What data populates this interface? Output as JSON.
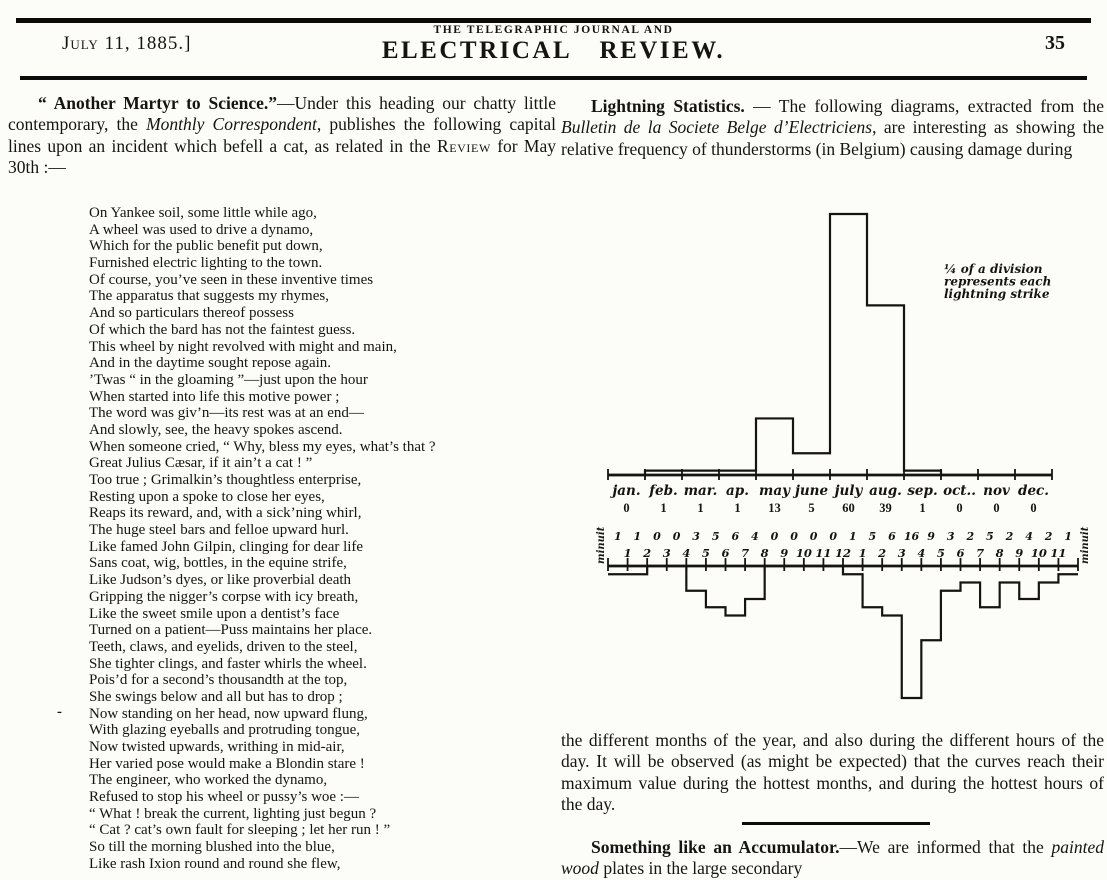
{
  "header": {
    "date": "July 11, 1885.]",
    "journal_line1": "THE TELEGRAPHIC JOURNAL AND",
    "journal_line2": "ELECTRICAL REVIEW.",
    "page_number": "35"
  },
  "left_column": {
    "intro": [
      [
        "bold",
        "“ Another Martyr to Science.”"
      ],
      [
        "plain",
        "—Under this heading our chatty little contemporary, the "
      ],
      [
        "italic",
        "Monthly Correspondent"
      ],
      [
        "plain",
        ", publishes the following capital lines upon an incident which befell a cat, as related in the "
      ],
      [
        "smallcaps",
        "Review"
      ],
      [
        "plain",
        " for May 30th :—"
      ]
    ],
    "margin_dash": "-",
    "poem_lines": [
      "On Yankee soil, some little while ago,",
      "A wheel was used to drive a dynamo,",
      "Which for the public benefit put down,",
      "Furnished electric lighting to the town.",
      "Of course, you’ve seen in these inventive times",
      "The apparatus that suggests my rhymes,",
      "And so particulars thereof  possess",
      "Of which the bard has not the faintest guess.",
      "This wheel by night revolved with might and main,",
      "And in the daytime sought repose again.",
      "’Twas “ in the gloaming ”—just upon the hour",
      "When started into life this motive power ;",
      "The word was giv’n—its rest was at an end—",
      "And slowly, see, the heavy spokes ascend.",
      "When someone cried, “ Why, bless my eyes, what’s that ?",
      "Great Julius Cæsar, if  it ain’t a cat ! ”",
      "Too true ;  Grimalkin’s thoughtless enterprise,",
      "Resting upon a spoke to close her eyes,",
      "Reaps its reward, and, with a sick’ning whirl,",
      "The huge steel bars and felloe upward hurl.",
      "Like famed John Gilpin, clinging for dear life",
      "Sans coat, wig, bottles, in the equine strife,",
      "Like Judson’s dyes, or like proverbial death",
      "Gripping the nigger’s corpse with icy breath,",
      "Like the sweet smile upon a dentist’s face",
      "Turned on a patient—Puss maintains her place.",
      "Teeth, claws, and eyelids, driven to the steel,",
      "She tighter clings, and faster whirls the wheel.",
      "Pois’d for a second’s thousandth at the top,",
      "She swings below and all but has to drop ;",
      "Now standing on her head, now upward flung,",
      "With glazing eyeballs and protruding tongue,",
      "Now twisted upwards, writhing in mid-air,",
      "Her varied pose would make a Blondin stare !",
      "The engineer, who worked the dynamo,",
      "Refused to stop his wheel or pussy’s woe :—",
      "“ What !  break the current, lighting just begun ?",
      "“ Cat ?   cat’s own fault for sleeping ;  let her run ! ”",
      "So till the morning blushed into the blue,",
      "Like rash Ixion round and round she flew,"
    ]
  },
  "right_column": {
    "intro": [
      [
        "bold",
        "Lightning  Statistics."
      ],
      [
        "plain",
        " — The  following  diagrams, extracted from the "
      ],
      [
        "italic",
        "Bulletin de la Societe Belge d’Electriciens"
      ],
      [
        "plain",
        ", are interesting as showing the relative frequency of thunderstorms (in Belgium) causing  damage  during"
      ]
    ],
    "below_chart": "the different months of the year, and also during the different hours of the day.  It will be observed (as might be expected) that the curves reach their maximum value during the hottest months, and during the hottest hours of the day.",
    "accumulator": [
      [
        "bold",
        "Something like an Accumulator."
      ],
      [
        "plain",
        "—We are informed that  the  "
      ],
      [
        "italic",
        "painted  wood"
      ],
      [
        "plain",
        "  plates  in  the  large  secondary"
      ]
    ]
  },
  "chart_data": [
    {
      "type": "bar",
      "style": "step-outline",
      "direction": "up",
      "categories": [
        "jan.",
        "feb.",
        "mar.",
        "ap.",
        "may",
        "june",
        "july",
        "aug.",
        "sep.",
        "oct..",
        "nov",
        "dec."
      ],
      "values": [
        0,
        1,
        1,
        1,
        13,
        5,
        60,
        39,
        1,
        0,
        0,
        0
      ],
      "annotation_lines": [
        "¼ of a division",
        "represents  each",
        "lightning strike"
      ],
      "grid": false
    },
    {
      "type": "bar",
      "style": "step-outline",
      "direction": "down",
      "tick_labels": [
        "1",
        "2",
        "3",
        "4",
        "5",
        "6",
        "7",
        "8",
        "9",
        "10",
        "11",
        "12",
        "1",
        "2",
        "3",
        "4",
        "5",
        "6",
        "7",
        "8",
        "9",
        "10",
        "11"
      ],
      "values": [
        1,
        1,
        0,
        0,
        3,
        5,
        6,
        4,
        0,
        0,
        0,
        0,
        1,
        5,
        6,
        16,
        9,
        3,
        2,
        5,
        2,
        4,
        2,
        1
      ],
      "end_labels": [
        "minuit",
        "minuit"
      ],
      "grid": false
    }
  ]
}
